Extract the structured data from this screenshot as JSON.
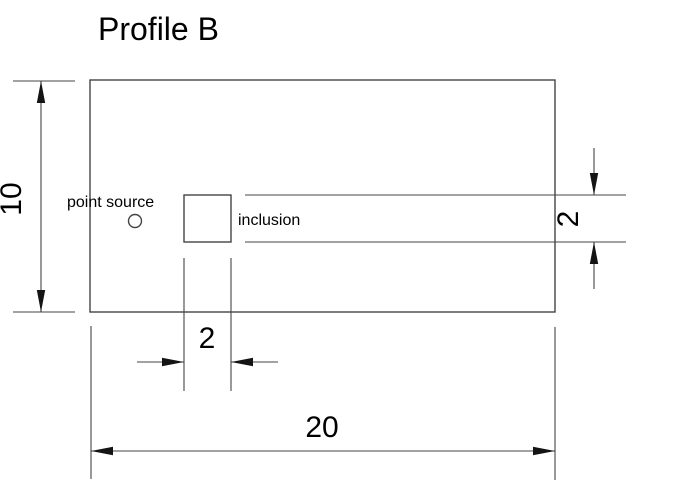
{
  "page": {
    "title": "Profile B"
  },
  "colors": {
    "background": "#ffffff",
    "line": "#454545",
    "text": "#000000",
    "arrow": "#141414"
  },
  "labels": {
    "point_source": "point source",
    "inclusion": "inclusion"
  },
  "dimensions": {
    "plate_height": {
      "value": "10",
      "orientation": "vertical",
      "side": "left"
    },
    "plate_width": {
      "value": "20",
      "orientation": "horizontal",
      "side": "bottom"
    },
    "inclusion_width": {
      "value": "2",
      "orientation": "horizontal",
      "side": "bottom"
    },
    "inclusion_height": {
      "value": "2",
      "orientation": "vertical",
      "side": "right"
    }
  }
}
